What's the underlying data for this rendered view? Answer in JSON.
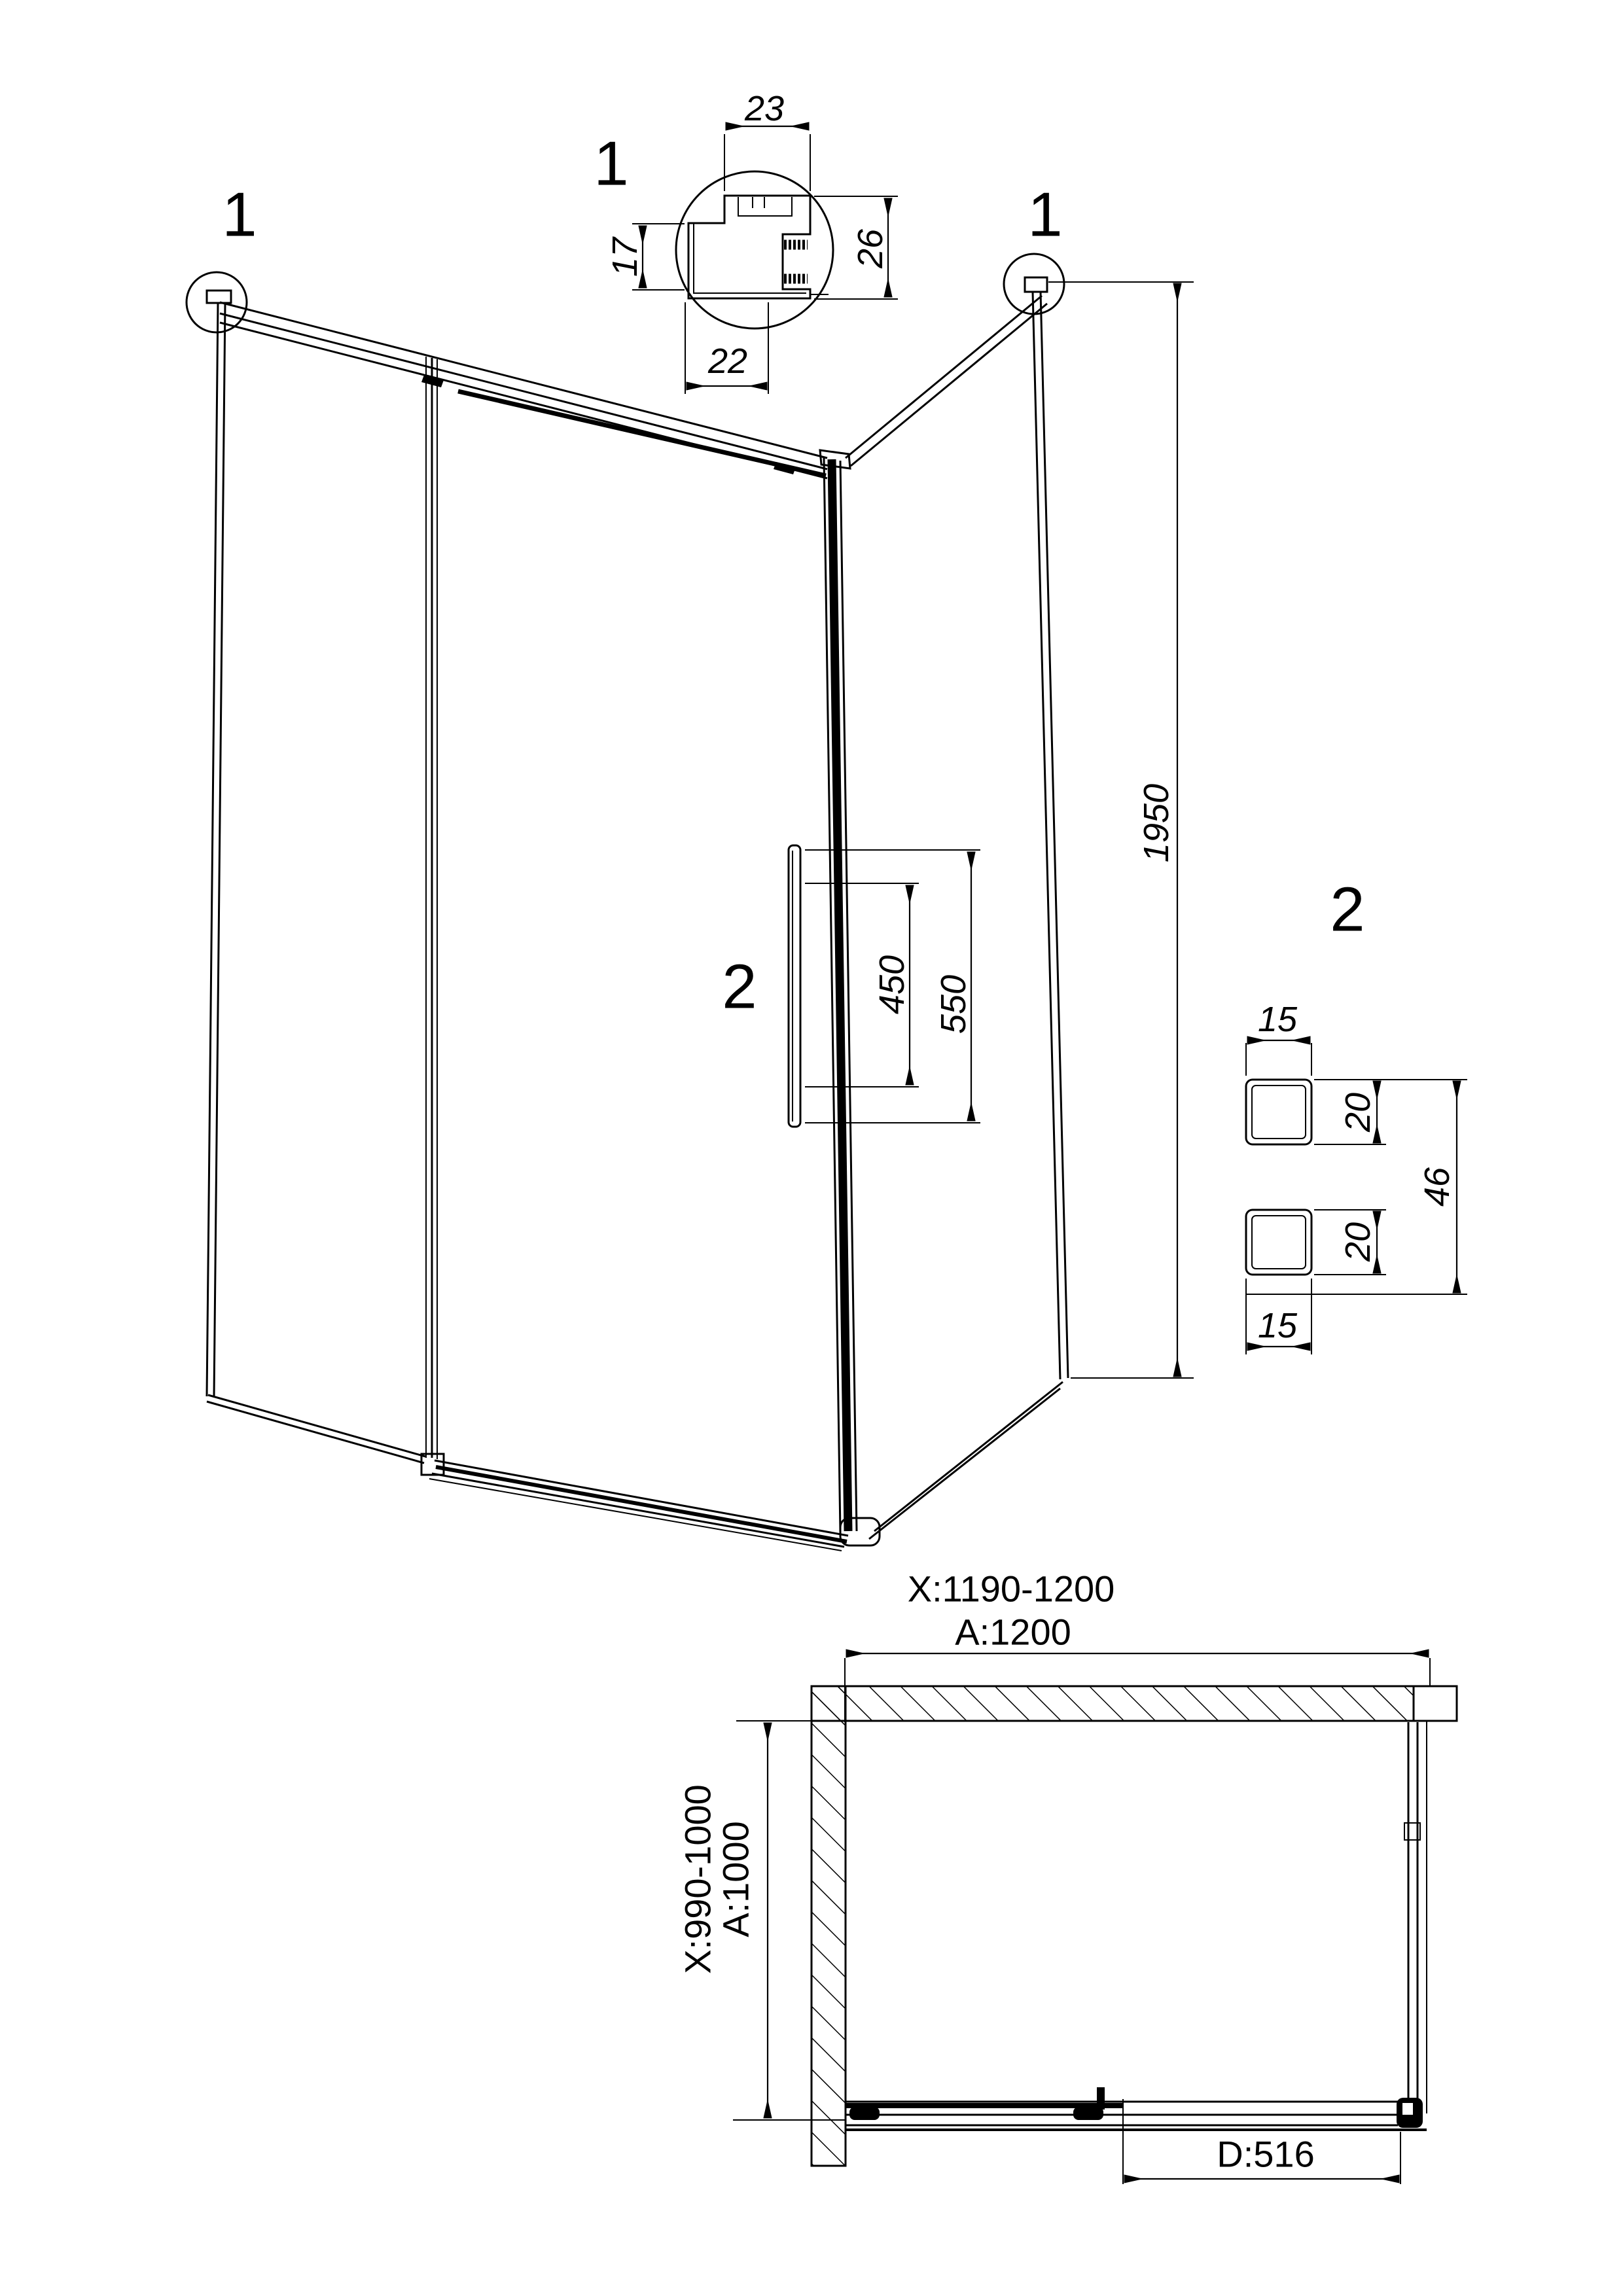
{
  "drawing": {
    "type": "shower-enclosure-technical-drawing",
    "detail1": {
      "label": "1",
      "width_top": "23",
      "height_right": "26",
      "height_left": "17",
      "width_bottom": "22"
    },
    "corner_markers": {
      "left_label": "1",
      "right_label": "1"
    },
    "main_view": {
      "overall_height": "1950",
      "handle_label": "2",
      "handle_inner_length": "450",
      "handle_outer_length": "550"
    },
    "detail2": {
      "label": "2",
      "top_bar_width": "15",
      "top_bar_height": "20",
      "bottom_bar_height": "20",
      "bottom_bar_width": "15",
      "overall": "46"
    },
    "plan_view": {
      "width_adjust_range": "X:1190-1200",
      "width_nominal": "A:1200",
      "depth_adjust_range": "X:990-1000",
      "depth_nominal": "A:1000",
      "door_opening": "D:516"
    }
  }
}
